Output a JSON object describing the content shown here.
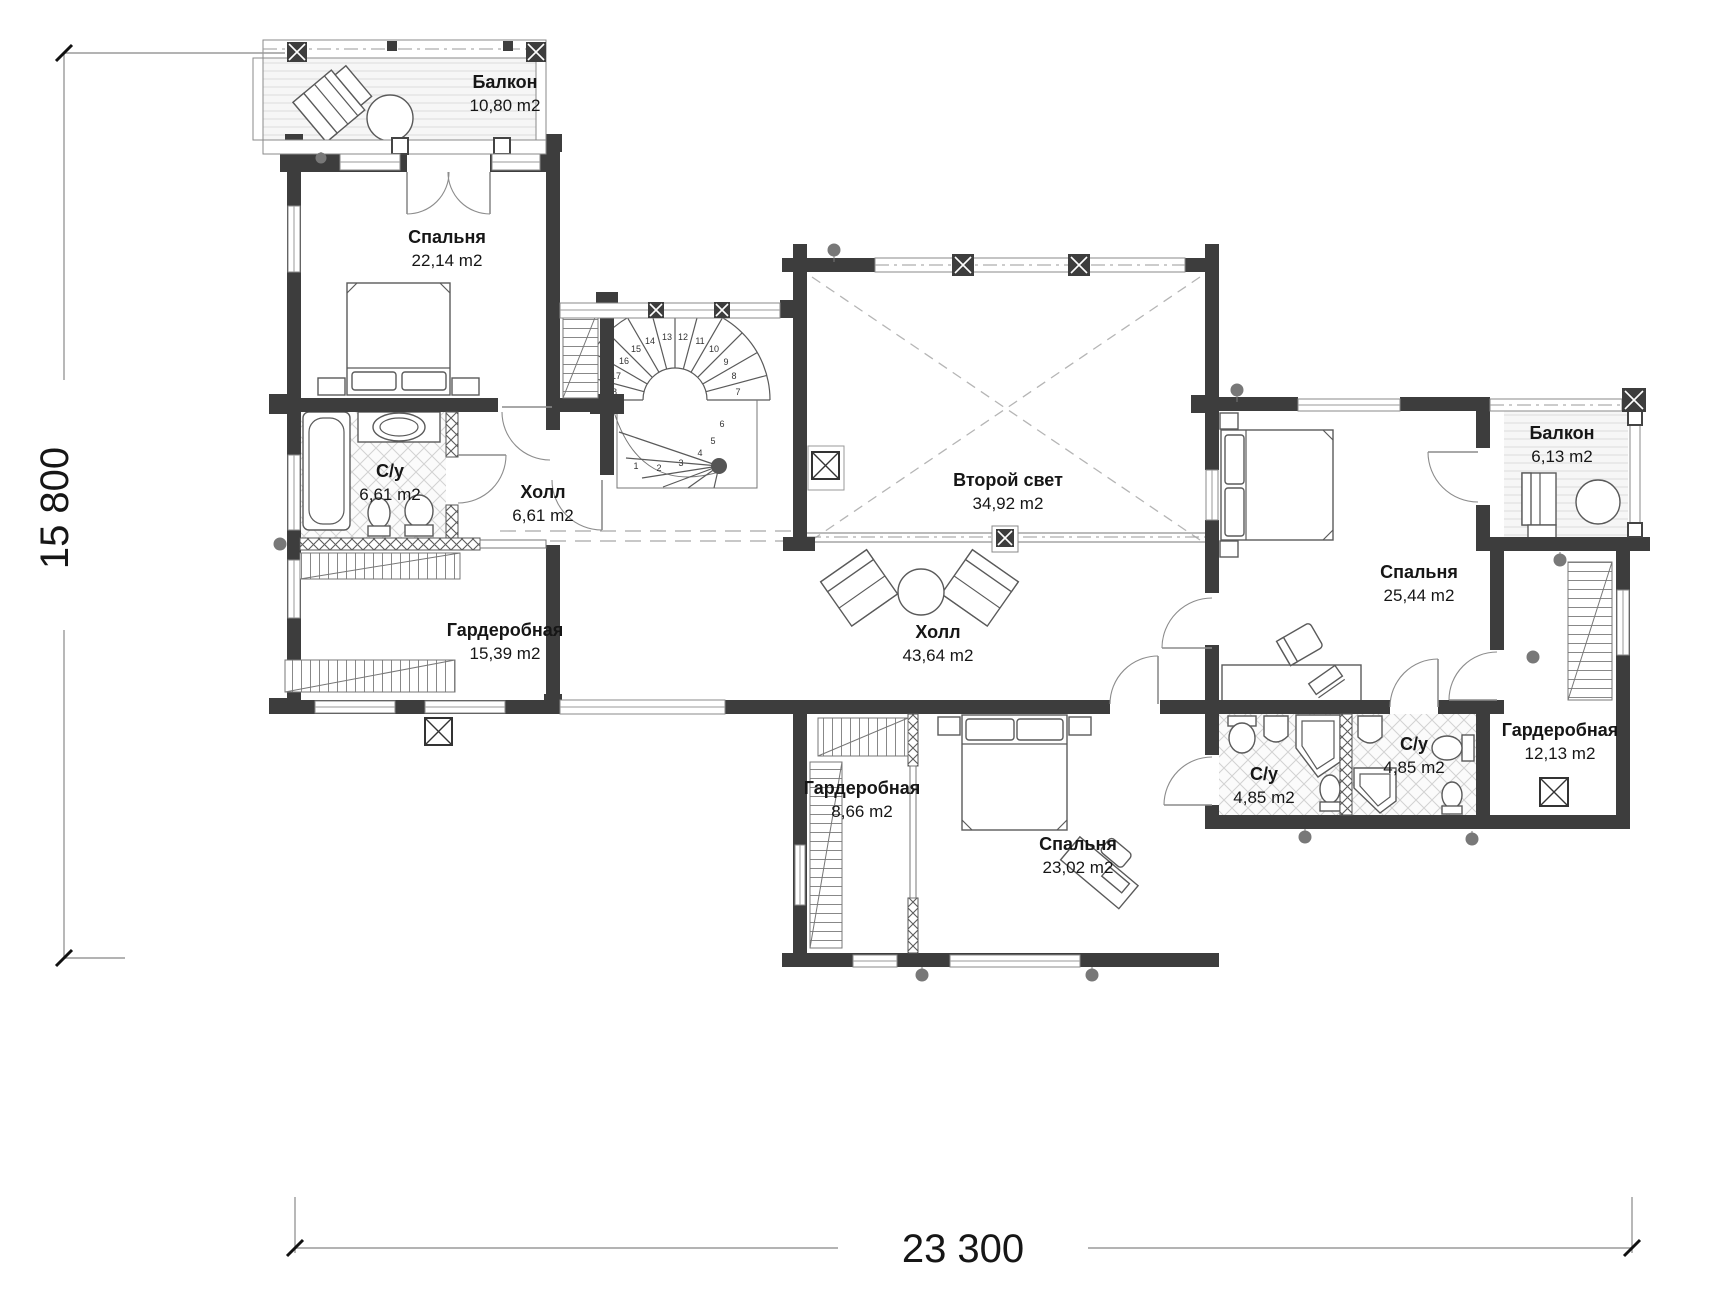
{
  "colors": {
    "wall": "#3d3d3d",
    "paper": "#ffffff"
  },
  "dimensions": {
    "vertical_total": "15 800",
    "horizontal_total": "23 300"
  },
  "rooms": [
    {
      "id": "balcony-top-left",
      "name": "Балкон",
      "area": "10,80 m2"
    },
    {
      "id": "bedroom-top-left",
      "name": "Спальня",
      "area": "22,14 m2"
    },
    {
      "id": "bathroom-left",
      "name": "С/у",
      "area": "6,61 m2"
    },
    {
      "id": "hall-small",
      "name": "Холл",
      "area": "6,61 m2"
    },
    {
      "id": "wardrobe-left",
      "name": "Гардеробная",
      "area": "15,39 m2"
    },
    {
      "id": "second-light-void",
      "name": "Второй свет",
      "area": "34,92 m2"
    },
    {
      "id": "hall-big",
      "name": "Холл",
      "area": "43,64 m2"
    },
    {
      "id": "bedroom-right",
      "name": "Спальня",
      "area": "25,44 m2"
    },
    {
      "id": "balcony-right",
      "name": "Балкон",
      "area": "6,13 m2"
    },
    {
      "id": "wardrobe-right",
      "name": "Гардеробная",
      "area": "12,13 m2"
    },
    {
      "id": "bathroom-right-2",
      "name": "С/у",
      "area": "4,85 m2"
    },
    {
      "id": "bathroom-right-1",
      "name": "С/у",
      "area": "4,85 m2"
    },
    {
      "id": "wardrobe-middle",
      "name": "Гардеробная",
      "area": "8,66 m2"
    },
    {
      "id": "bedroom-bottom",
      "name": "Спальня",
      "area": "23,02 m2"
    }
  ],
  "stair": {
    "steps": [
      "1",
      "2",
      "3",
      "4",
      "5",
      "6",
      "7",
      "8",
      "9",
      "10",
      "11",
      "12",
      "13",
      "14",
      "15",
      "16",
      "17",
      "18"
    ]
  }
}
